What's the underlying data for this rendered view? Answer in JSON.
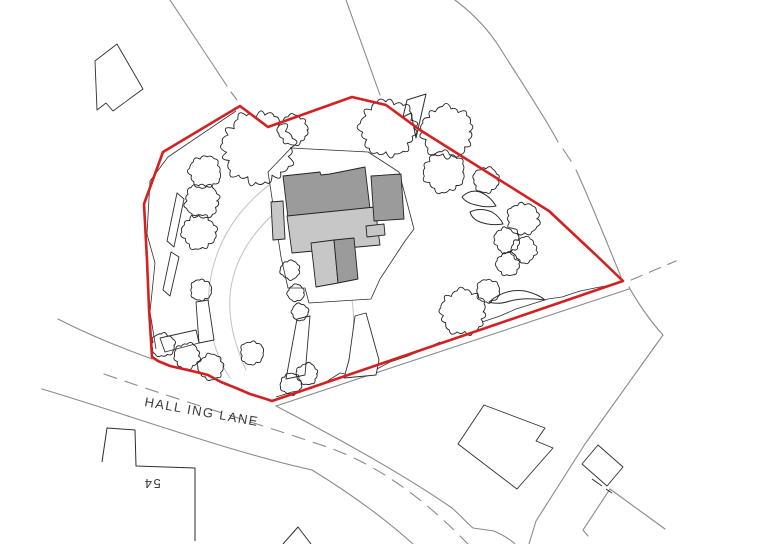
{
  "plan": {
    "road_name": "HALL ING LANE",
    "house_number": "54"
  },
  "colors": {
    "boundary-red": "#d42020",
    "line-gray": "#8a8a8a",
    "path-light": "#c2c2c2",
    "outline-dark": "#2e2e2e",
    "building-dark": "#9b9b9b",
    "building-light": "#c7c7c7",
    "label-gray": "#3a3a3a",
    "background": "#ffffff"
  },
  "map": {
    "site_boundary": [
      [
        240,
        106
      ],
      [
        163,
        152
      ],
      [
        144,
        204
      ],
      [
        147,
        260
      ],
      [
        149,
        308
      ],
      [
        152,
        357
      ],
      [
        158,
        361
      ],
      [
        170,
        366
      ],
      [
        183,
        369
      ],
      [
        196,
        372
      ],
      [
        208,
        375
      ],
      [
        221,
        382
      ],
      [
        236,
        388
      ],
      [
        250,
        394
      ],
      [
        263,
        398
      ],
      [
        272,
        401
      ],
      [
        623,
        281
      ],
      [
        597,
        256
      ],
      [
        549,
        211
      ],
      [
        420,
        130
      ],
      [
        386,
        105
      ],
      [
        352,
        97
      ],
      [
        268,
        127
      ]
    ],
    "trees": [
      [
        258,
        148,
        33
      ],
      [
        293,
        130,
        14
      ],
      [
        388,
        128,
        26
      ],
      [
        447,
        132,
        24
      ],
      [
        444,
        172,
        19
      ],
      [
        486,
        180,
        12
      ],
      [
        205,
        172,
        15
      ],
      [
        202,
        201,
        16
      ],
      [
        199,
        232,
        16
      ],
      [
        201,
        290,
        10
      ],
      [
        290,
        270,
        9
      ],
      [
        296,
        293,
        8
      ],
      [
        300,
        312,
        8
      ],
      [
        307,
        374,
        10
      ],
      [
        291,
        384,
        10
      ],
      [
        163,
        345,
        11
      ],
      [
        187,
        356,
        12
      ],
      [
        211,
        367,
        12
      ],
      [
        252,
        353,
        11
      ],
      [
        463,
        312,
        21
      ],
      [
        488,
        291,
        11
      ],
      [
        523,
        219,
        15
      ],
      [
        507,
        240,
        12
      ],
      [
        524,
        250,
        12
      ],
      [
        508,
        264,
        11
      ]
    ]
  }
}
